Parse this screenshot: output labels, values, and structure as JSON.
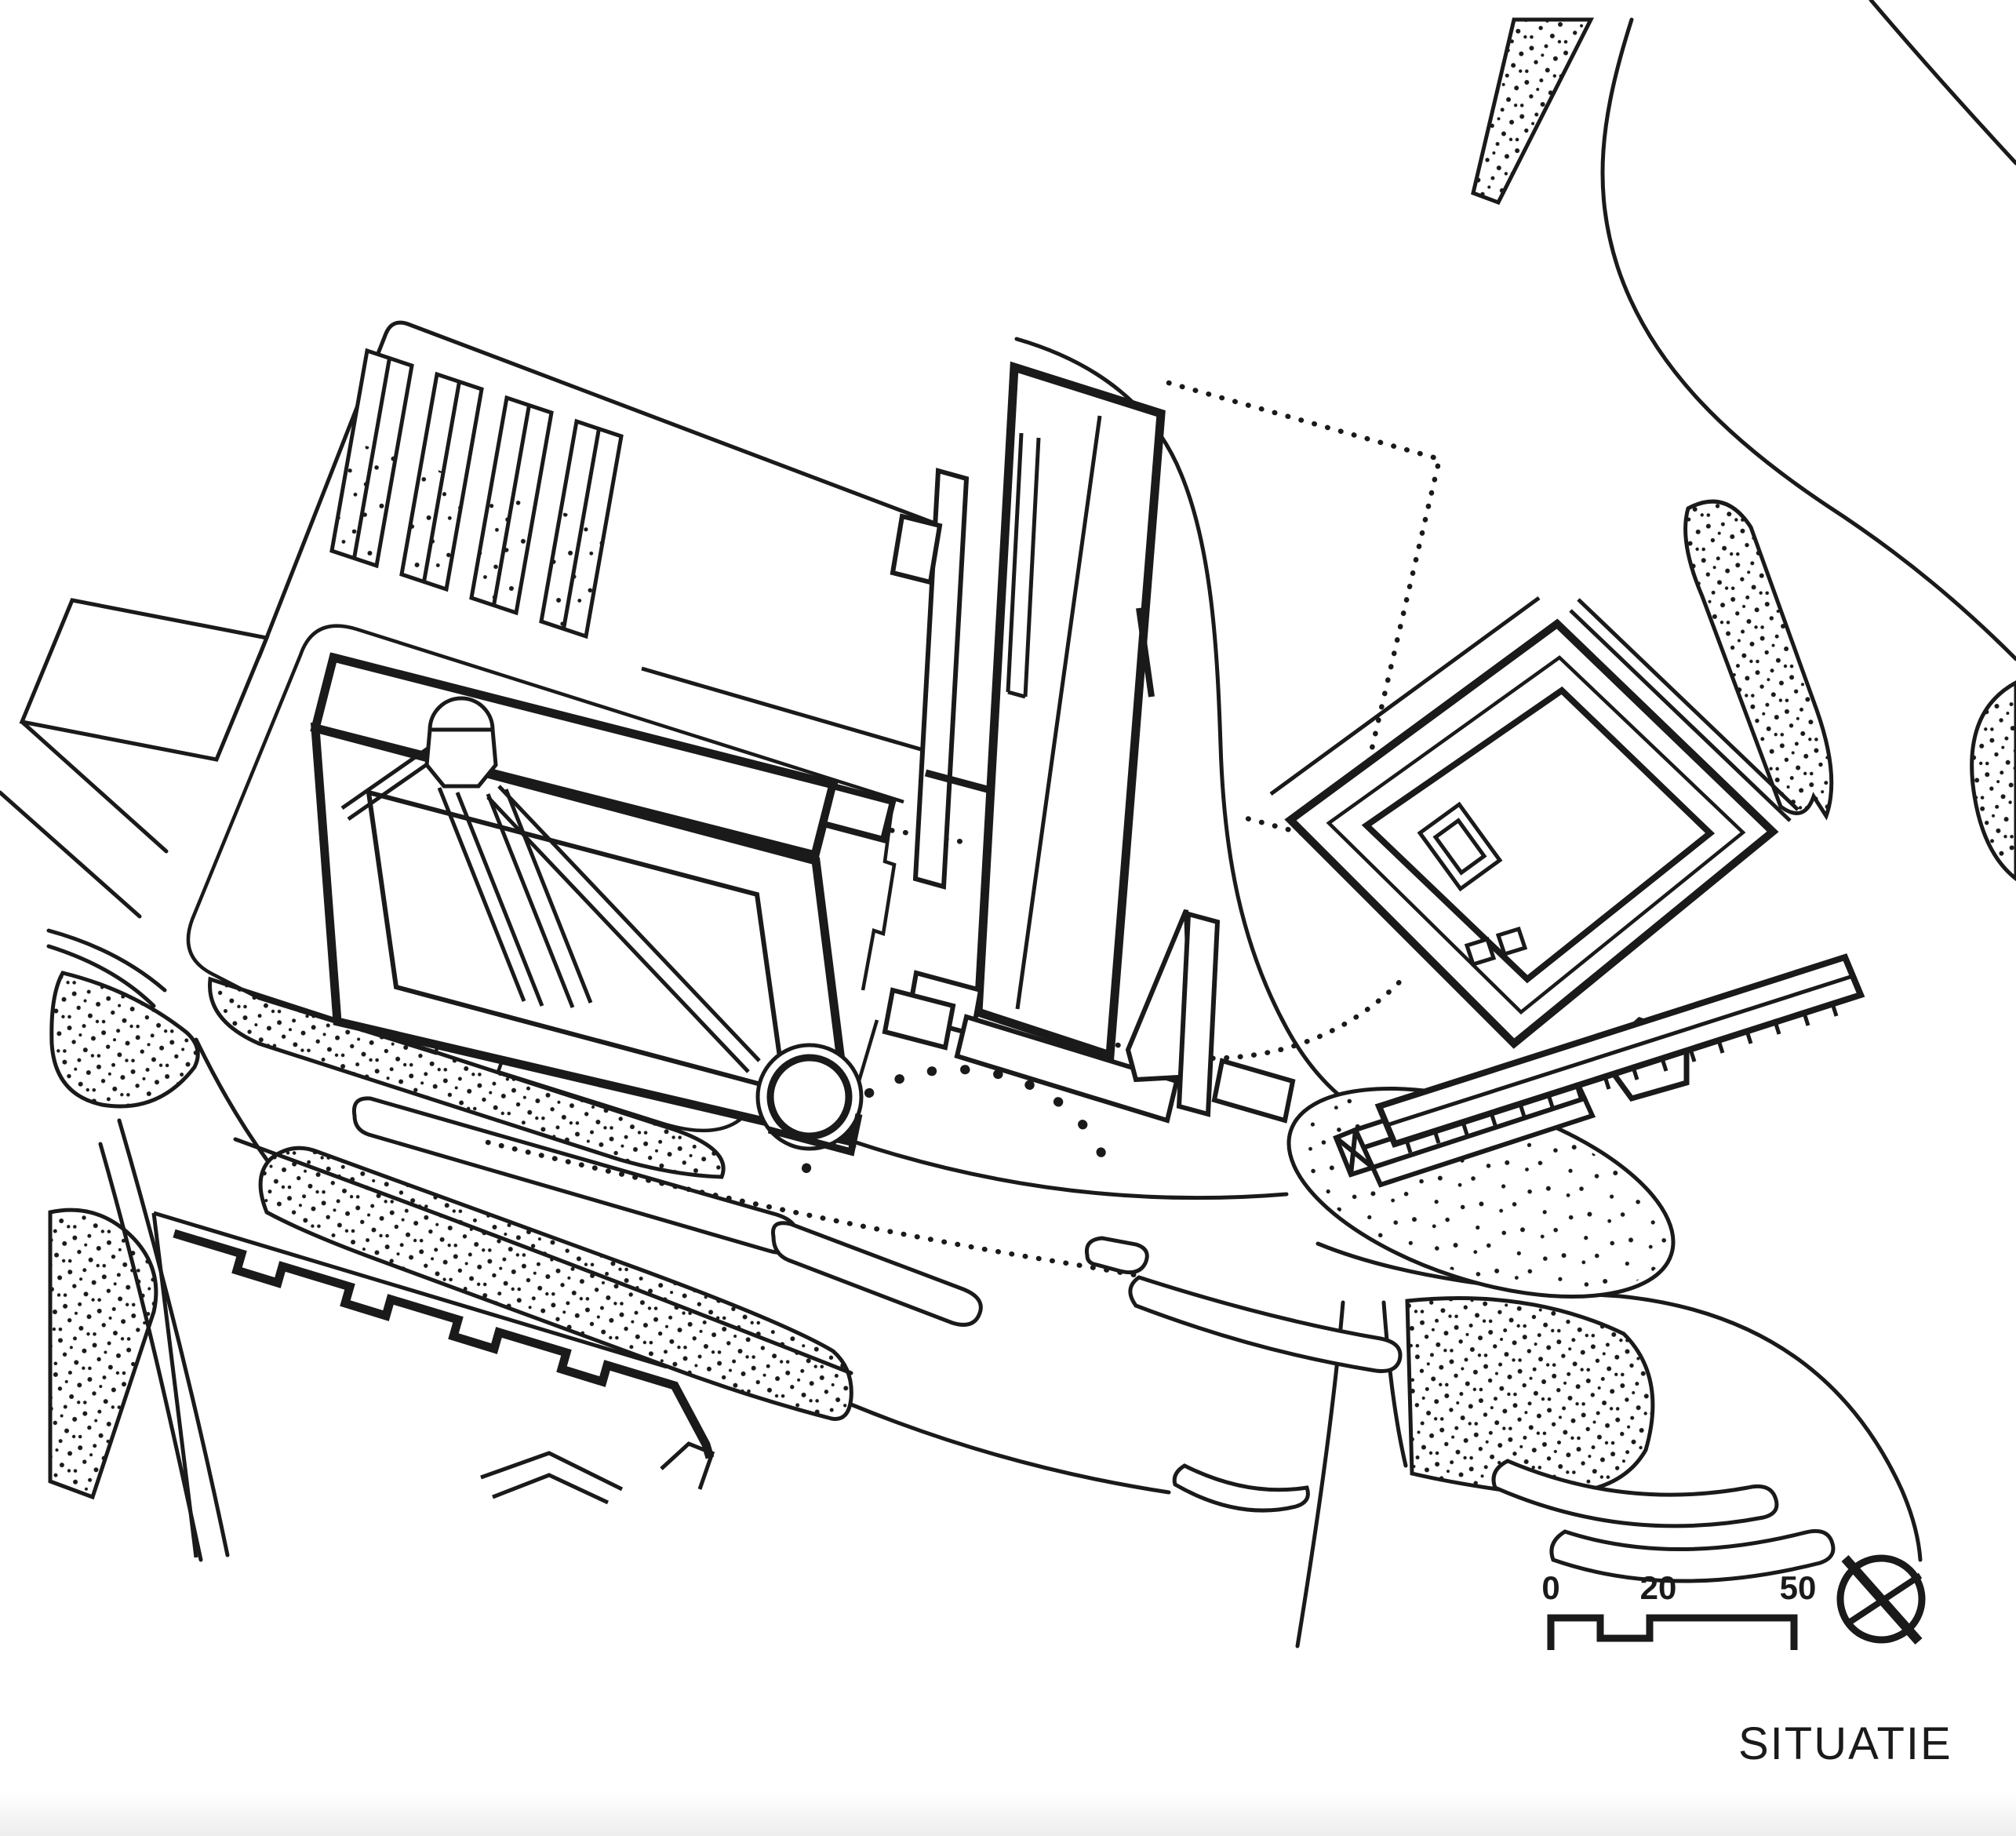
{
  "title": {
    "label": "SITUATIE"
  },
  "scale_bar": {
    "labels": [
      "0",
      "20",
      "50"
    ]
  },
  "colors": {
    "ink": "#1a1a1a",
    "paper": "#ffffff"
  },
  "symbols": {
    "north_arrow": "compass-cross-icon"
  },
  "drawing": {
    "type": "architectural-site-plan",
    "features": [
      "parking-strips",
      "main-building-with-round-tower",
      "tall-slab-building",
      "courtyard-building",
      "gabled-house-on-island",
      "roads-and-medians",
      "planted-verges-stippled",
      "plaza-dotted-arc",
      "housing-block-crenellated",
      "scale-bar",
      "north-arrow"
    ]
  }
}
